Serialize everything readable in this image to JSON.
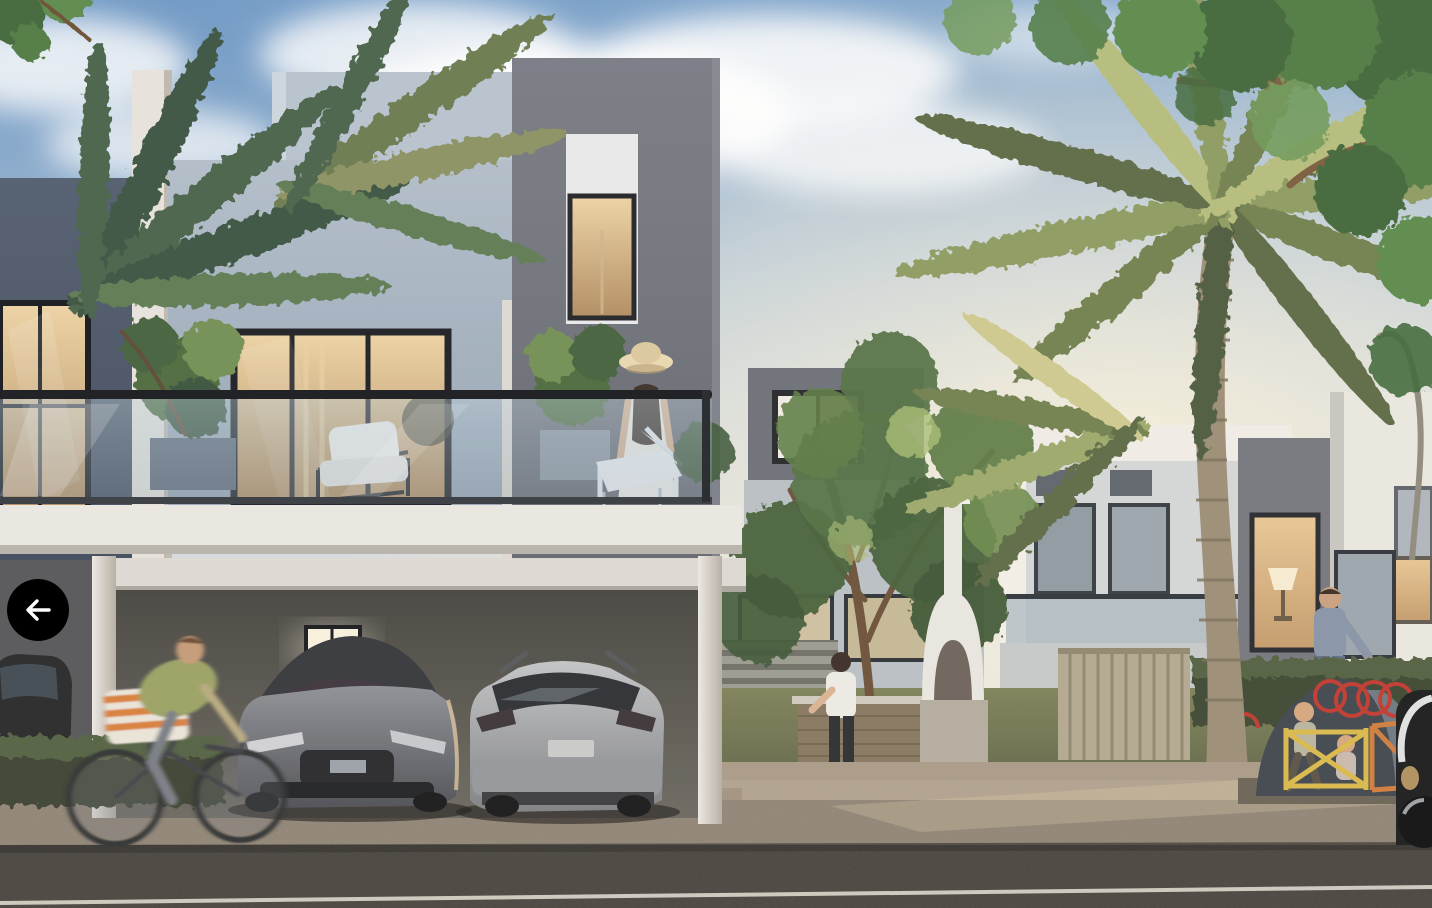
{
  "view": {
    "kind": "property-photo-viewer"
  },
  "back_button": {
    "aria_label": "Back",
    "icon": "arrow-left-icon",
    "background_color": "#000000",
    "icon_color": "#ffffff"
  },
  "photo": {
    "alt": "Rendering of a modern villa community at dusk: white and grey two-storey houses, a balcony with a woman in a sun hat beside an armchair and potted shrubs, a carport sheltering a grey sedan and a silver SUV, a cyclist passing on the sidewalk, palm trees and a leafy tree, a garden barbecue area with a white oven, neighbours with children near a playground with red rings and yellow-orange fences, and an asphalt street in the foreground.",
    "palette": {
      "sky_top": "#7fa5cc",
      "sky_horizon": "#efe7d6",
      "facade_light": "#e9e7e2",
      "facade_blue_grey": "#a9b6c4",
      "facade_dark_grey": "#6e7077",
      "slate_wall": "#4a5668",
      "window_glow": "#e0bb84",
      "vegetation_dark": "#3f5638",
      "vegetation_light": "#9fb468",
      "asphalt": "#37342f",
      "sidewalk": "#9a8b77",
      "playground_red": "#c0392f",
      "playground_yellow": "#d9b94a",
      "playground_orange": "#cf7c3d"
    }
  }
}
